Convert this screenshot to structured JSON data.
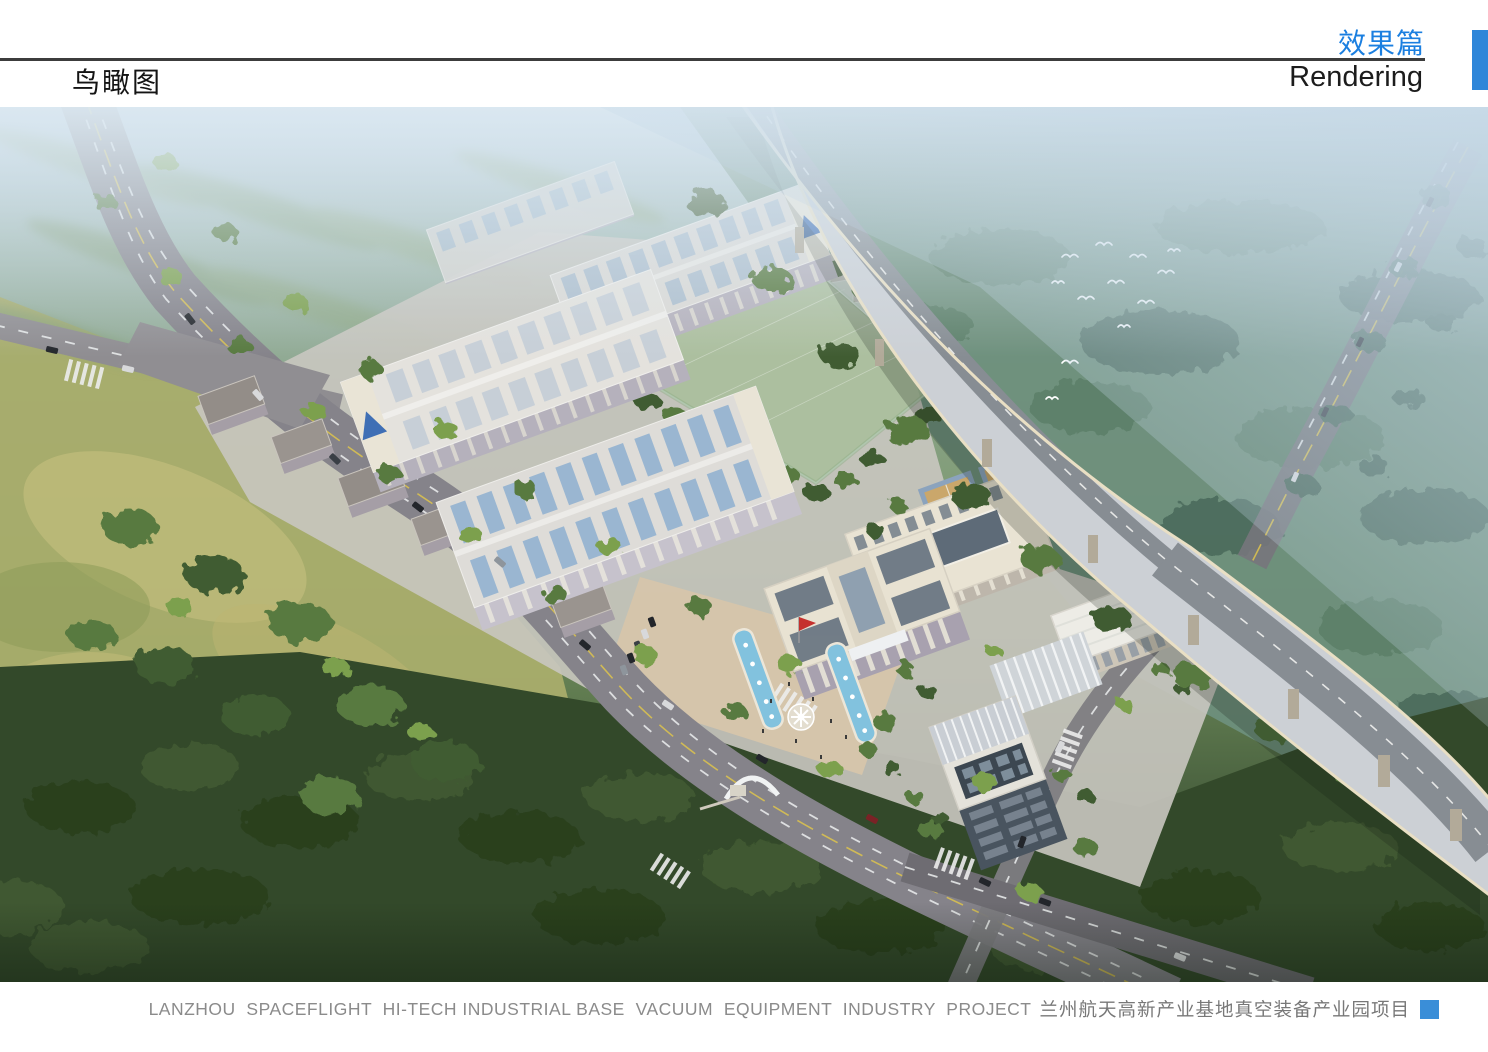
{
  "header": {
    "title_cn": "鸟瞰图",
    "section_cn": "效果篇",
    "section_en": "Rendering"
  },
  "footer": {
    "caption_en": "LANZHOU  SPACEFLIGHT  HI-TECH INDUSTRIAL BASE  VACUUM  EQUIPMENT  INDUSTRY  PROJECT",
    "caption_cn": "兰州航天高新产业基地真空装备产业园项目"
  },
  "colors": {
    "section_title_blue": "#1b7fe0",
    "side_tab_blue": "#2e86d9",
    "caption_gray": "#8b8b8b",
    "caption_marker_blue": "#3a8ed8",
    "header_rule": "#3c3c3c"
  }
}
